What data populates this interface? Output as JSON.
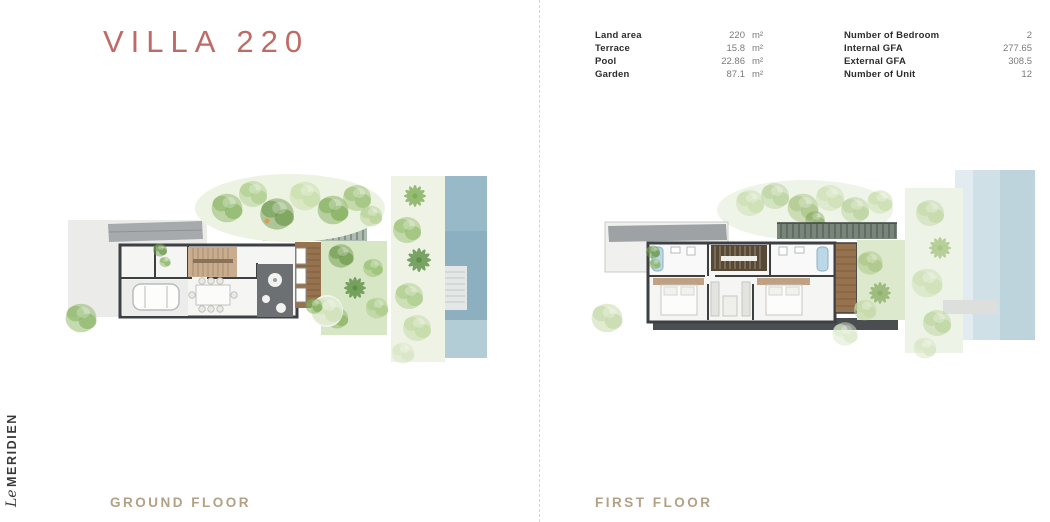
{
  "title": "VILLA 220",
  "brand": {
    "logo_text_script": "Le",
    "logo_text_caps": "MERIDIEN"
  },
  "specs": {
    "left": [
      {
        "label": "Land area",
        "value": "220",
        "unit": "m²"
      },
      {
        "label": "Terrace",
        "value": "15.8",
        "unit": "m²"
      },
      {
        "label": "Pool",
        "value": "22.86",
        "unit": "m²"
      },
      {
        "label": "Garden",
        "value": "87.1",
        "unit": "m²"
      }
    ],
    "right": [
      {
        "label": "Number of Bedroom",
        "value": "2"
      },
      {
        "label": "Internal GFA",
        "value": "277.65"
      },
      {
        "label": "External GFA",
        "value": "308.5"
      },
      {
        "label": "Number of Unit",
        "value": "12"
      }
    ]
  },
  "plans": {
    "ground": {
      "label": "GROUND FLOOR"
    },
    "first": {
      "label": "FIRST FLOOR"
    }
  },
  "colors": {
    "title_color": "#c06a66",
    "floor_label_color": "#b3a186",
    "spec_label_color": "#2d2d2d",
    "spec_value_color": "#7a7a7a",
    "divider_color": "#d4d4d4"
  }
}
